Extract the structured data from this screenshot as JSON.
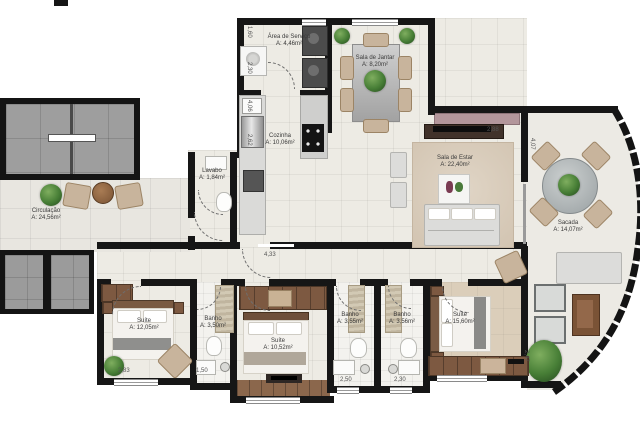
{
  "plan": {
    "title": "Planta de apartamento",
    "rooms": [
      {
        "id": "area-servico",
        "name": "Área de Serviço",
        "area": "A: 4,46m²"
      },
      {
        "id": "sala-jantar",
        "name": "Sala de Jantar",
        "area": "A: 8,20m²"
      },
      {
        "id": "cozinha",
        "name": "Cozinha",
        "area": "A: 10,06m²"
      },
      {
        "id": "lavabo",
        "name": "Lavabo",
        "area": "A: 1,84m²"
      },
      {
        "id": "sala-estar",
        "name": "Sala de Estar",
        "area": "A: 22,40m²"
      },
      {
        "id": "sacada",
        "name": "Sacada",
        "area": "A: 14,07m²"
      },
      {
        "id": "circulacao",
        "name": "Circulação",
        "area": "A: 24,56m²"
      },
      {
        "id": "suite-1",
        "name": "Suíte",
        "area": "A: 12,05m²"
      },
      {
        "id": "banho-1",
        "name": "Banho",
        "area": "A: 3,50m²"
      },
      {
        "id": "suite-2",
        "name": "Suíte",
        "area": "A: 10,52m²"
      },
      {
        "id": "banho-2",
        "name": "Banho",
        "area": "A: 3,55m²"
      },
      {
        "id": "banho-3",
        "name": "Banho",
        "area": "A: 3,56m²"
      },
      {
        "id": "suite-master",
        "name": "Suíte",
        "area": "A: 15,60m²"
      }
    ],
    "dimensions": [
      "1,60",
      "2,30",
      "4,06",
      "2,62",
      "2,88",
      "4,07",
      "4,33",
      "1,50",
      "2,83",
      "2,50",
      "2,47",
      "2,30"
    ],
    "colors": {
      "wall": "#161616",
      "floor": "#edebe4",
      "wood": "#7d5941",
      "plant": "#477e36"
    }
  }
}
